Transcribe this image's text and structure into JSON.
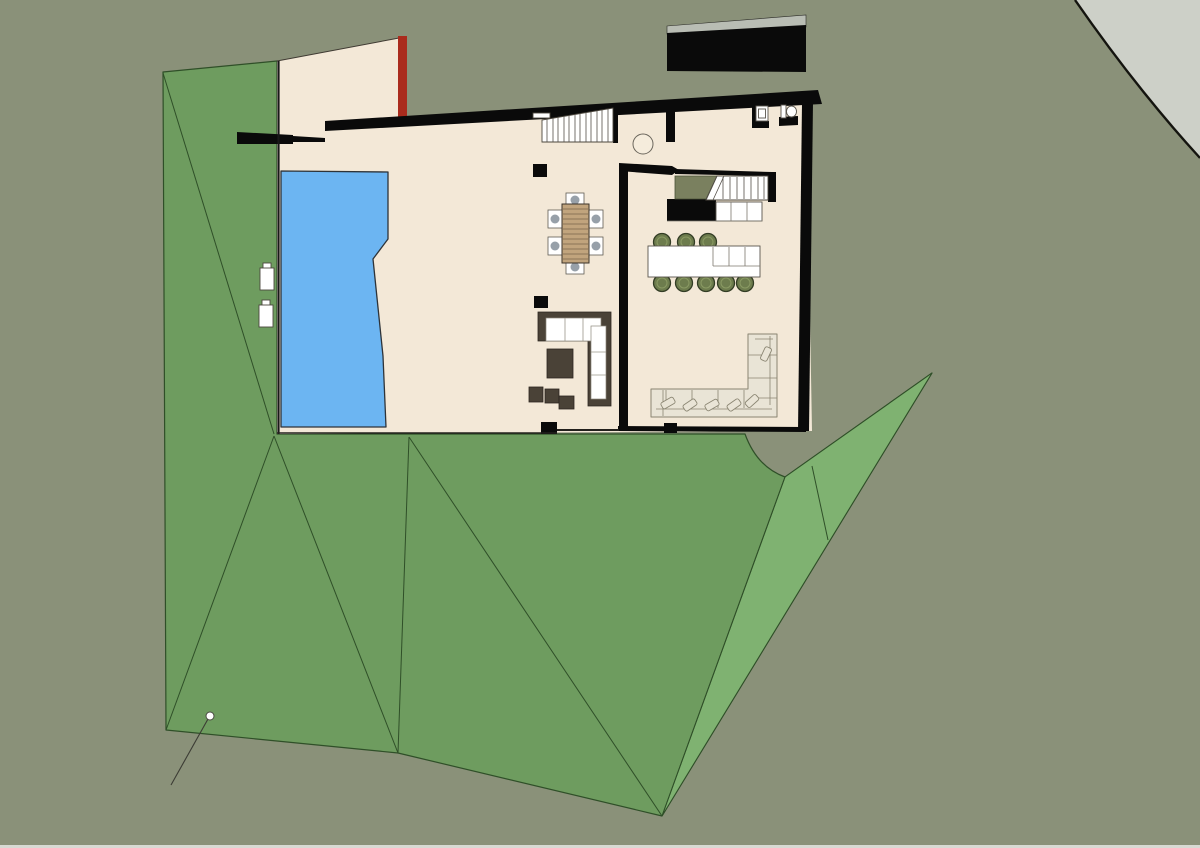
{
  "meta": {
    "description": "Top-down architectural site plan of a hillside villa: open-plan ground floor with pool, courtyard, carport, kitchen island, dining set, two sofas, stairs and terraced green landscape. No text labels are visible in the rendering."
  },
  "colors": {
    "background": "#8a9179",
    "road": "#cdd0c8",
    "roadEdge": "#14140f",
    "terrain": "#6e9c5f",
    "terrainLight": "#7fb271",
    "terrainLine": "#2f4f28",
    "floor": "#f3e8d7",
    "wall": "#0a0a0a",
    "red": "#aa2b1d",
    "pool": "#6cb5f2",
    "poolEdge": "#2e3338",
    "structGray": "#b9bdb4",
    "voidOlive": "#7a805f",
    "stool": "#6d7c4d",
    "stoolEdge": "#333d25",
    "wood": "#c1a47d",
    "woodLine": "#77644a",
    "chairSeat": "#97a0a9",
    "frameDark": "#4a4237",
    "sofaCream": "#e9e4d6",
    "sofaLine": "#8a8572",
    "thinLine": "#3f3a32",
    "bottomStrip": "#d8dad3"
  },
  "geometry": {
    "road_path": "M1075,0 Q1136,88 1200,158 L1200,0 Z",
    "road_edge_path": "M1075,0 Q1136,88 1200,158",
    "terrain_path": "M163,72 L277,61 L277,434 L745,434 Q757,467 785,477 L932,373 L662,816 L398,753 L166,730 Z",
    "terrain_wedge_points": "785,477 932,373 662,816",
    "pool_points": "281,171 388,172 388,239 373,259 383,356 386,427 281,427",
    "courtyard_points": "277,61 399,38 399,131 277,140",
    "floor_points": "277,128 806,92 812,431 277,434",
    "folds": [
      "163,73 274,434",
      "274,436 166,730",
      "274,436 398,753",
      "409,437 398,753",
      "409,437 662,816",
      "785,477 662,816",
      "812,466 828,540"
    ],
    "leader_points": "208,719 171,785"
  }
}
